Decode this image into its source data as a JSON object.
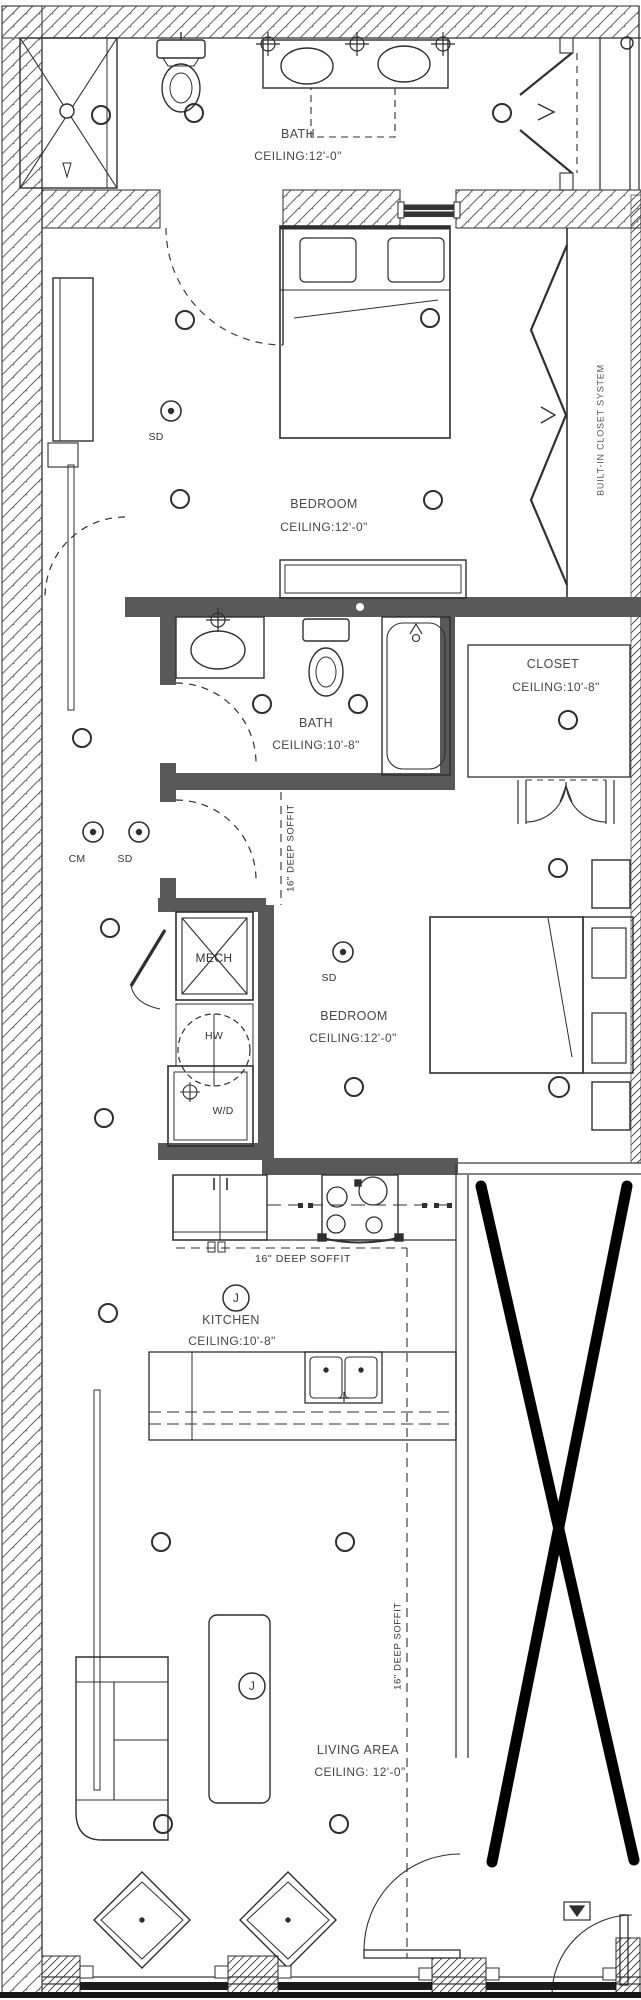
{
  "rooms": {
    "bath_upper": {
      "name": "BATH",
      "ceiling": "CEILING:12'-0\""
    },
    "bedroom_upper": {
      "name": "BEDROOM",
      "ceiling": "CEILING:12'-0\""
    },
    "bath_mid": {
      "name": "BATH",
      "ceiling": "CEILING:10'-8\""
    },
    "closet": {
      "name": "CLOSET",
      "ceiling": "CEILING:10'-8\""
    },
    "bedroom_mid": {
      "name": "BEDROOM",
      "ceiling": "CEILING:12'-0\""
    },
    "kitchen": {
      "name": "KITCHEN",
      "ceiling": "CEILING:10'-8\""
    },
    "living": {
      "name": "LIVING AREA",
      "ceiling": "CEILING: 12'-0\""
    }
  },
  "annotations": {
    "mech": "MECH",
    "hw": "HW",
    "wd": "W/D",
    "sd": "SD",
    "cm": "CM",
    "junction": "J",
    "soffit": "16\" DEEP SOFFIT",
    "closet_system": "BUILT-IN CLOSET SYSTEM"
  },
  "colors": {
    "line": "#2f2f2f",
    "wall_dark": "#595959",
    "text": "#474747",
    "x_mark": "#000000"
  }
}
